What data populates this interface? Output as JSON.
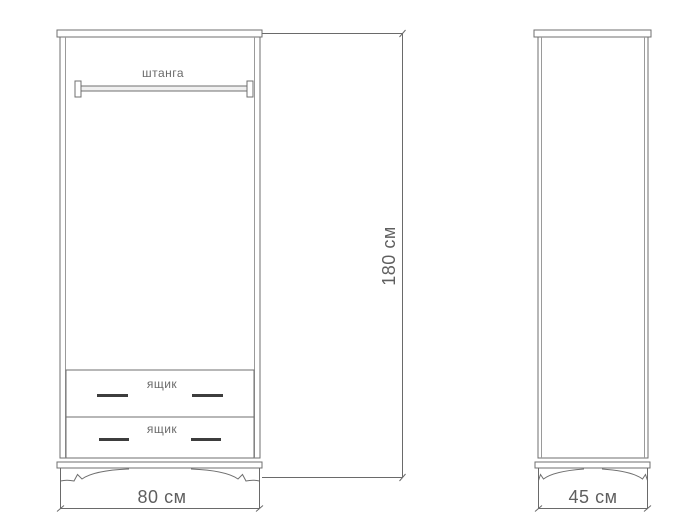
{
  "drawing": {
    "type": "furniture-technical-drawing",
    "subject": "wardrobe-front-and-side-views",
    "front_view": {
      "rod_label": "штанга",
      "drawers": [
        {
          "label": "ящик"
        },
        {
          "label": "ящик"
        }
      ],
      "width_dimension": "80 см",
      "height_dimension": "180 см"
    },
    "side_view": {
      "depth_dimension": "45 см"
    },
    "colors": {
      "background": "#ffffff",
      "line": "#6f6f6f",
      "text": "#5f5f5f",
      "handle": "#3d3d3d"
    }
  }
}
